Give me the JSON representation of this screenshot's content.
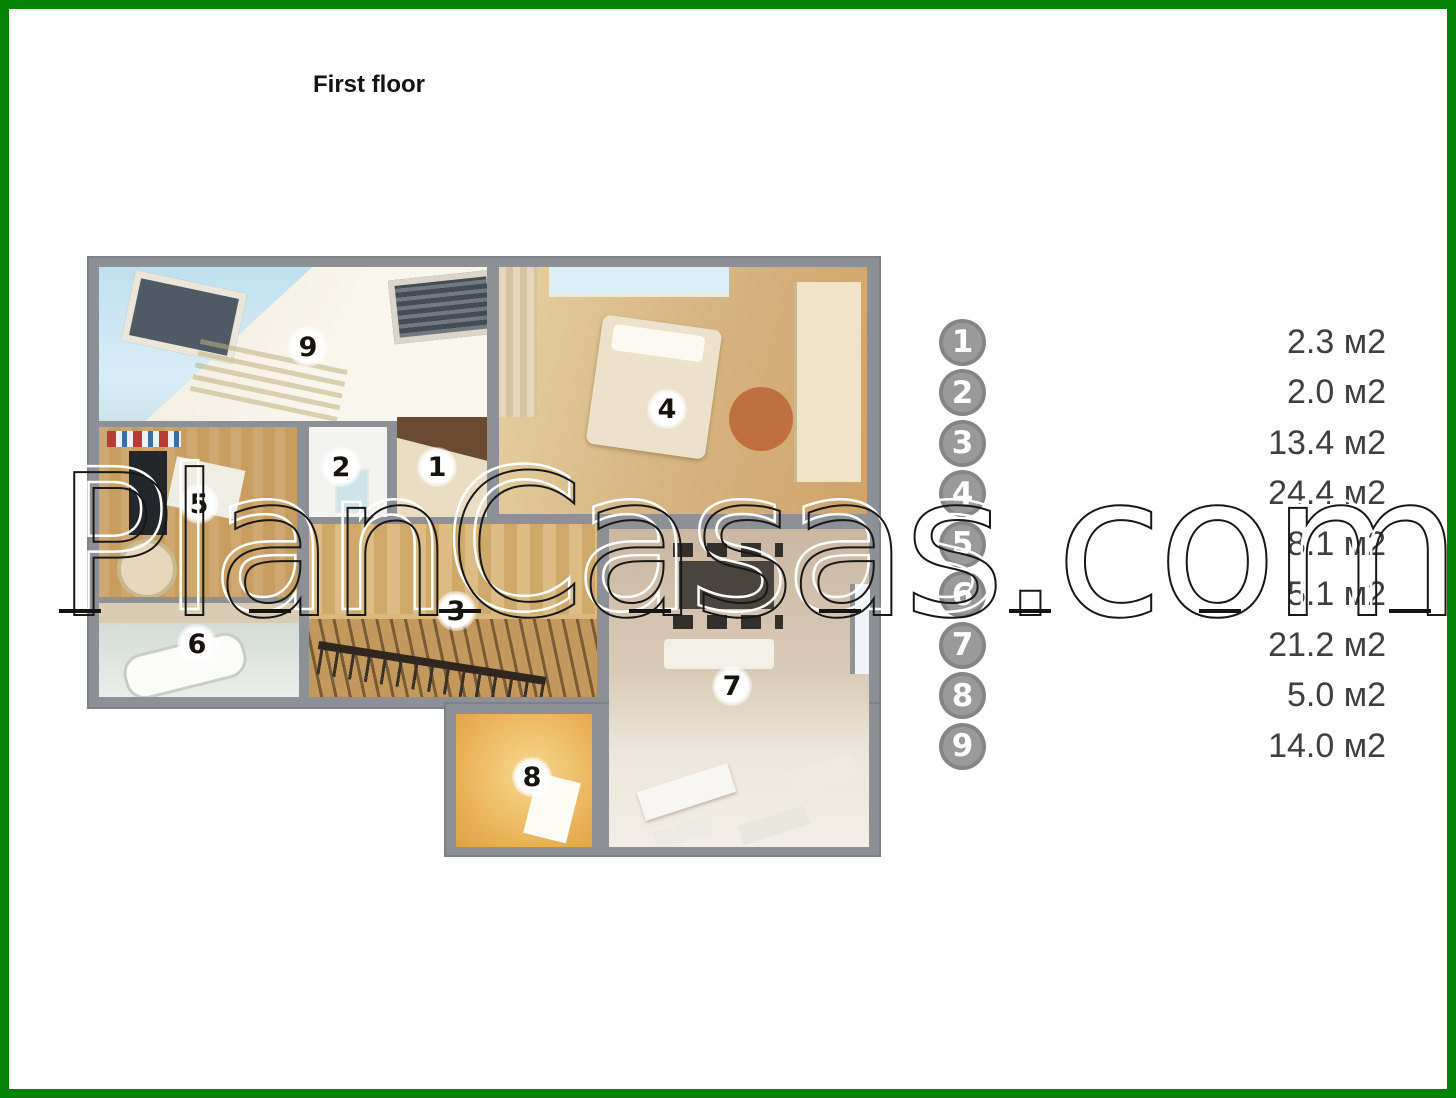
{
  "title": "First floor",
  "watermark": {
    "text": "PlanCasas.com"
  },
  "legend": {
    "items": [
      {
        "num": "1",
        "area": "2.3 м2"
      },
      {
        "num": "2",
        "area": "2.0 м2"
      },
      {
        "num": "3",
        "area": "13.4 м2"
      },
      {
        "num": "4",
        "area": "24.4 м2"
      },
      {
        "num": "5",
        "area": "8.1 м2"
      },
      {
        "num": "6",
        "area": "5.1 м2"
      },
      {
        "num": "7",
        "area": "21.2 м2"
      },
      {
        "num": "8",
        "area": "5.0 м2"
      },
      {
        "num": "9",
        "area": "14.0 м2"
      }
    ]
  },
  "floorplan": {
    "rooms": [
      {
        "num": "1"
      },
      {
        "num": "2"
      },
      {
        "num": "3"
      },
      {
        "num": "4"
      },
      {
        "num": "5"
      },
      {
        "num": "6"
      },
      {
        "num": "7"
      },
      {
        "num": "8"
      },
      {
        "num": "9"
      }
    ]
  },
  "colors": {
    "frame_green": "#048404",
    "wall_gray": "#8d9196",
    "legend_circle_gray": "#8f8f8f",
    "legend_text": "#3f3f3f"
  }
}
